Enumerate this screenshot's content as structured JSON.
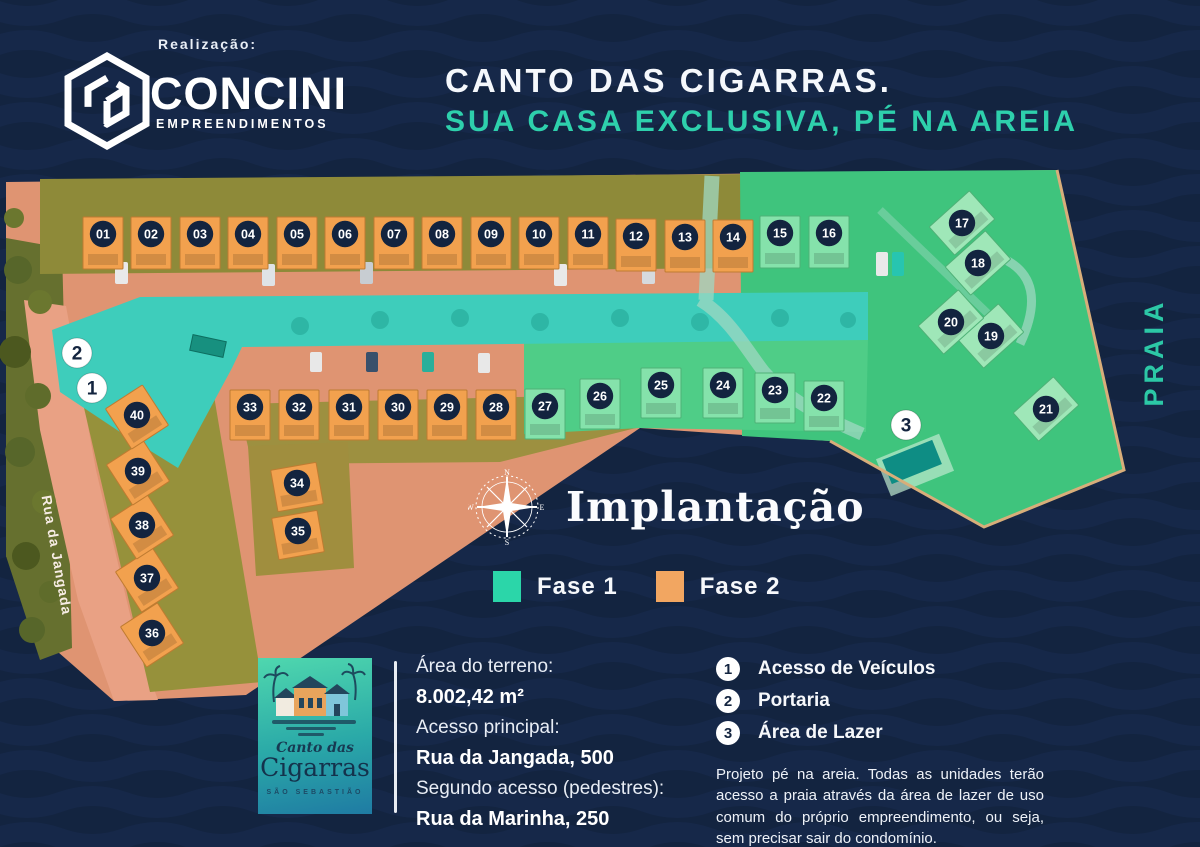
{
  "header": {
    "realization_label": "Realização:",
    "brand_name": "CONCINI",
    "brand_subtitle": "EMPREENDIMENTOS",
    "title_line1": "CANTO DAS CIGARRAS.",
    "title_line2": "SUA CASA EXCLUSIVA, PÉ NA AREIA"
  },
  "map": {
    "praia_label": "PRAIA",
    "street_label": "Rua da Jangada",
    "phase1_color": "#2bd6a9",
    "phase2_color": "#f2a661",
    "units": [
      {
        "n": "01",
        "x": 103,
        "y": 234,
        "p": 2
      },
      {
        "n": "02",
        "x": 151,
        "y": 234,
        "p": 2
      },
      {
        "n": "03",
        "x": 200,
        "y": 234,
        "p": 2
      },
      {
        "n": "04",
        "x": 248,
        "y": 234,
        "p": 2
      },
      {
        "n": "05",
        "x": 297,
        "y": 234,
        "p": 2
      },
      {
        "n": "06",
        "x": 345,
        "y": 234,
        "p": 2
      },
      {
        "n": "07",
        "x": 394,
        "y": 234,
        "p": 2
      },
      {
        "n": "08",
        "x": 442,
        "y": 234,
        "p": 2
      },
      {
        "n": "09",
        "x": 491,
        "y": 234,
        "p": 2
      },
      {
        "n": "10",
        "x": 539,
        "y": 234,
        "p": 2
      },
      {
        "n": "11",
        "x": 588,
        "y": 234,
        "p": 2
      },
      {
        "n": "12",
        "x": 636,
        "y": 236,
        "p": 2
      },
      {
        "n": "13",
        "x": 685,
        "y": 237,
        "p": 2
      },
      {
        "n": "14",
        "x": 733,
        "y": 237,
        "p": 2
      },
      {
        "n": "15",
        "x": 780,
        "y": 233,
        "p": 1
      },
      {
        "n": "16",
        "x": 829,
        "y": 233,
        "p": 1
      },
      {
        "n": "17",
        "x": 962,
        "y": 223,
        "p": 1
      },
      {
        "n": "18",
        "x": 978,
        "y": 263,
        "p": 1
      },
      {
        "n": "19",
        "x": 991,
        "y": 336,
        "p": 1
      },
      {
        "n": "20",
        "x": 951,
        "y": 322,
        "p": 1
      },
      {
        "n": "21",
        "x": 1046,
        "y": 409,
        "p": 1
      },
      {
        "n": "22",
        "x": 824,
        "y": 398,
        "p": 1
      },
      {
        "n": "23",
        "x": 775,
        "y": 390,
        "p": 1
      },
      {
        "n": "24",
        "x": 723,
        "y": 385,
        "p": 1
      },
      {
        "n": "25",
        "x": 661,
        "y": 385,
        "p": 1
      },
      {
        "n": "26",
        "x": 600,
        "y": 396,
        "p": 1
      },
      {
        "n": "27",
        "x": 545,
        "y": 406,
        "p": 1
      },
      {
        "n": "28",
        "x": 496,
        "y": 407,
        "p": 2
      },
      {
        "n": "29",
        "x": 447,
        "y": 407,
        "p": 2
      },
      {
        "n": "30",
        "x": 398,
        "y": 407,
        "p": 2
      },
      {
        "n": "31",
        "x": 349,
        "y": 407,
        "p": 2
      },
      {
        "n": "32",
        "x": 299,
        "y": 407,
        "p": 2
      },
      {
        "n": "33",
        "x": 250,
        "y": 407,
        "p": 2
      },
      {
        "n": "34",
        "x": 297,
        "y": 483,
        "p": 2
      },
      {
        "n": "35",
        "x": 298,
        "y": 531,
        "p": 2
      },
      {
        "n": "36",
        "x": 152,
        "y": 633,
        "p": 2
      },
      {
        "n": "37",
        "x": 147,
        "y": 578,
        "p": 2
      },
      {
        "n": "38",
        "x": 142,
        "y": 525,
        "p": 2
      },
      {
        "n": "39",
        "x": 138,
        "y": 471,
        "p": 2
      },
      {
        "n": "40",
        "x": 137,
        "y": 415,
        "p": 2
      }
    ],
    "markers": [
      {
        "n": "1",
        "x": 92,
        "y": 388
      },
      {
        "n": "2",
        "x": 77,
        "y": 353
      },
      {
        "n": "3",
        "x": 906,
        "y": 425
      }
    ]
  },
  "plan": {
    "title": "Implantação"
  },
  "legend": {
    "items": [
      {
        "label": "Fase 1",
        "color": "#2bd6a9"
      },
      {
        "label": "Fase 2",
        "color": "#f2a661"
      }
    ]
  },
  "project_logo": {
    "script_line": "Canto das",
    "name_line": "Cigarras",
    "city_line": "SÃO SEBASTIÃO"
  },
  "details": {
    "rows": [
      {
        "label": "Área do terreno:",
        "value": "8.002,42 m²"
      },
      {
        "label": "Acesso principal:",
        "value": "Rua da Jangada, 500"
      },
      {
        "label": "Segundo acesso (pedestres):",
        "value": "Rua da Marinha, 250"
      }
    ]
  },
  "points": {
    "items": [
      {
        "n": "1",
        "label": "Acesso de Veículos"
      },
      {
        "n": "2",
        "label": "Portaria"
      },
      {
        "n": "3",
        "label": "Área de Lazer"
      }
    ]
  },
  "note": "Projeto pé na areia. Todas as unidades terão acesso a praia através da área de lazer de uso comum do próprio empreendimento, ou seja, sem precisar sair do condomínio."
}
